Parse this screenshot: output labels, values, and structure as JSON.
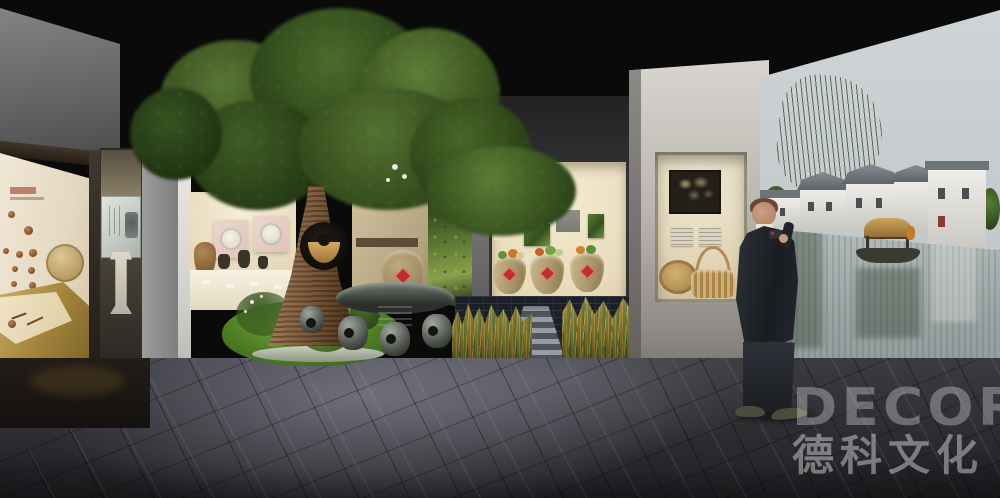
{
  "watermark": {
    "logo_text": "DECOR",
    "company_name": "德科文化",
    "color": "rgba(255,255,255,0.34)"
  },
  "objects": {
    "left_exhibit": "artifact-display-wall",
    "winnowing_basket": "woven-winnowing-basket",
    "gold_case": "gold-artifact-showcase",
    "calligraphy_panel": "calligraphy-glass-panel",
    "stele": "stone-stele",
    "tree": "ancient-banyan-tree",
    "trunk_ornament": "straw-hat-display",
    "plate_display": "ceramics-display-case",
    "stone_table": "stone-table-and-stools",
    "moss_wall": "moss-photo-mural-wall",
    "jar_display": "pickle-jar-alcove",
    "reeds": "rice-reed-planting",
    "niche": "basket-art-niche",
    "visitor": "visitor-in-suit",
    "watertown_mural": "jiangnan-watertown-photo-mural",
    "boat": "wooden-canopy-boat",
    "floor": "dark-stone-plaza-floor"
  },
  "palette": {
    "ceiling": "#0a0a0b",
    "floor_dark": "#2b2b30",
    "floor_light": "#8c8c96",
    "left_panel_cream": "#e9dfcc",
    "gold_case": "#a98f45",
    "tree_green_dark": "#2e4520",
    "tree_green_mid": "#4d6c2e",
    "tree_green_light": "#79a24f",
    "trunk_brown": "#8a6847",
    "moss_wall_green": "#55742e",
    "alcove_warm": "#efe5c8",
    "jar_tan": "#b3a076",
    "jar_label_red": "#c62f35",
    "reed_amber": "#b08a3c",
    "mural_sky": "#c7cccf",
    "mural_water": "#9fa9ab",
    "wall_gray": "#b9b7b2",
    "suit_dark": "#23262b"
  }
}
